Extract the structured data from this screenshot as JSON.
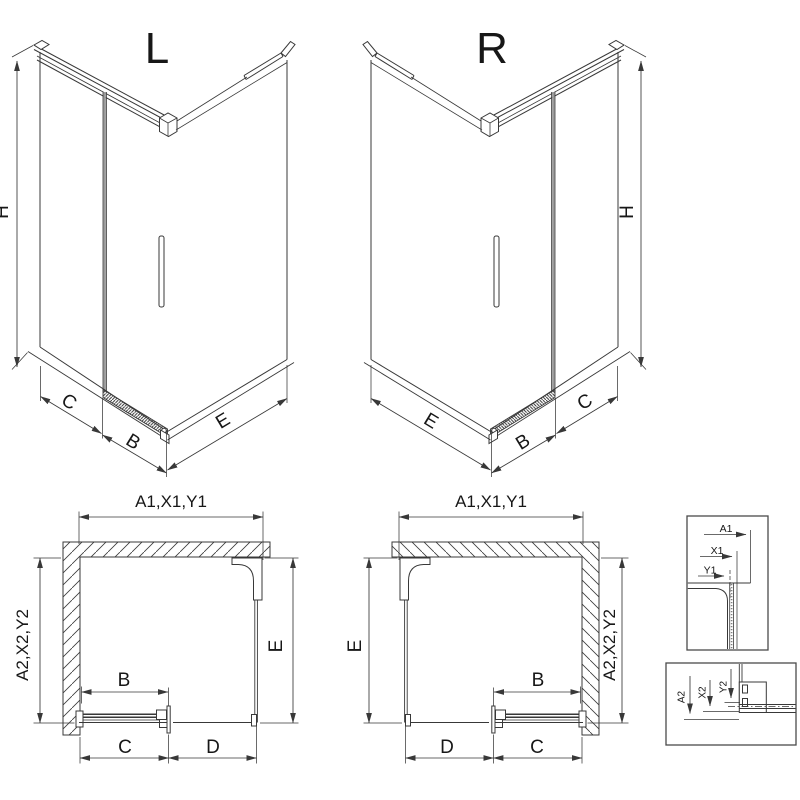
{
  "colors": {
    "line": "#383838",
    "glass_line": "#9a9a9a",
    "text": "#171717",
    "background": "#ffffff"
  },
  "iso_left": {
    "title": "L",
    "height": "H",
    "back": "C",
    "door": "B",
    "side": "E"
  },
  "iso_right": {
    "title": "R",
    "height": "H",
    "back": "C",
    "door": "B",
    "side": "E"
  },
  "plan_left": {
    "top": "A1,X1,Y1",
    "left": "A2,X2,Y2",
    "right": "E",
    "door": "B",
    "bottom_inner": "C",
    "bottom_outer": "D"
  },
  "plan_right": {
    "top": "A1,X1,Y1",
    "right": "A2,X2,Y2",
    "left": "E",
    "door": "B",
    "bottom_outer": "D",
    "bottom_inner": "C"
  },
  "detail_top": {
    "a1": "A1",
    "x1": "X1",
    "y1": "Y1"
  },
  "detail_bottom": {
    "a2": "A2",
    "x2": "X2",
    "y2": "Y2"
  }
}
